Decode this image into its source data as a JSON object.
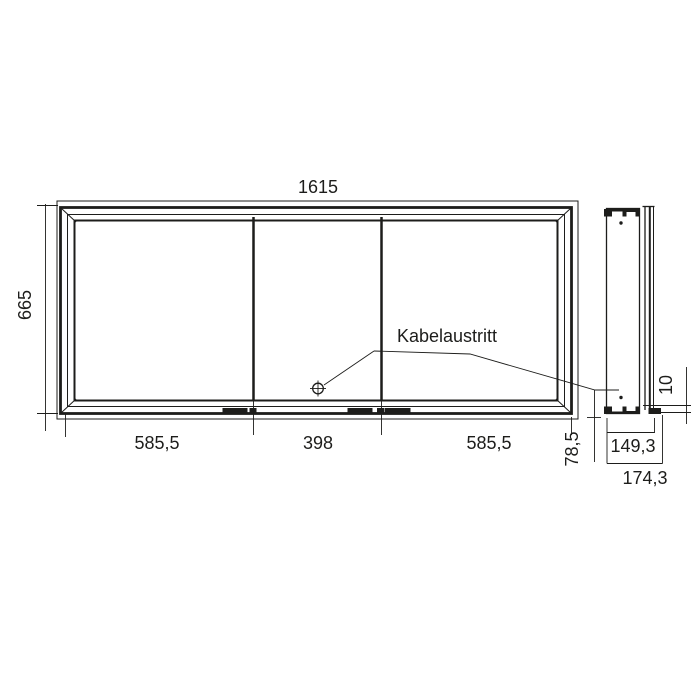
{
  "drawing": {
    "annotation": {
      "cable_outlet_label": "Kabelaustritt"
    },
    "front_view": {
      "overall_width": "1615",
      "overall_height": "665",
      "segment_widths": [
        "585,5",
        "398",
        "585,5"
      ]
    },
    "side_view": {
      "inner_depth": "149,3",
      "overall_depth": "174,3",
      "cable_outlet_height": "78,5",
      "front_overhang": "10"
    },
    "colors": {
      "line": "#1d1d1b",
      "background": "#ffffff"
    }
  }
}
